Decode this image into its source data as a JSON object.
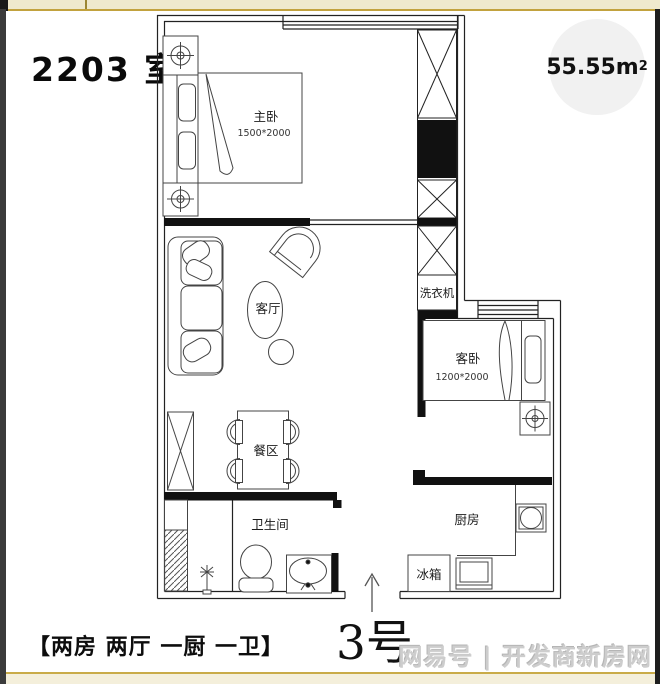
{
  "frame": {
    "top_bar_color": "#efe9cd",
    "gold_line_color": "#c2a23e",
    "left_strip_color": "#3b3b3b",
    "right_strip_color": "#1e1e1e"
  },
  "header": {
    "unit_title": "2203 室"
  },
  "area_badge": {
    "value": "55.55m",
    "sup": "2"
  },
  "plan": {
    "master_bedroom": {
      "label": "主卧",
      "dimensions": "1500*2000"
    },
    "living_room": {
      "label": "客厅"
    },
    "guest_bedroom": {
      "label": "客卧",
      "dimensions": "1200*2000"
    },
    "dining_area": {
      "label": "餐区"
    },
    "bathroom": {
      "label": "卫生间"
    },
    "kitchen": {
      "label": "厨房"
    },
    "washing_machine": {
      "label": "洗衣机"
    },
    "fridge": {
      "label": "冰箱"
    },
    "entrance": {
      "unit_number": "3号"
    }
  },
  "footer": {
    "layout_summary": "【两房 两厅 一厨 一卫】",
    "watermark": "网易号 | 开发商新房网"
  }
}
